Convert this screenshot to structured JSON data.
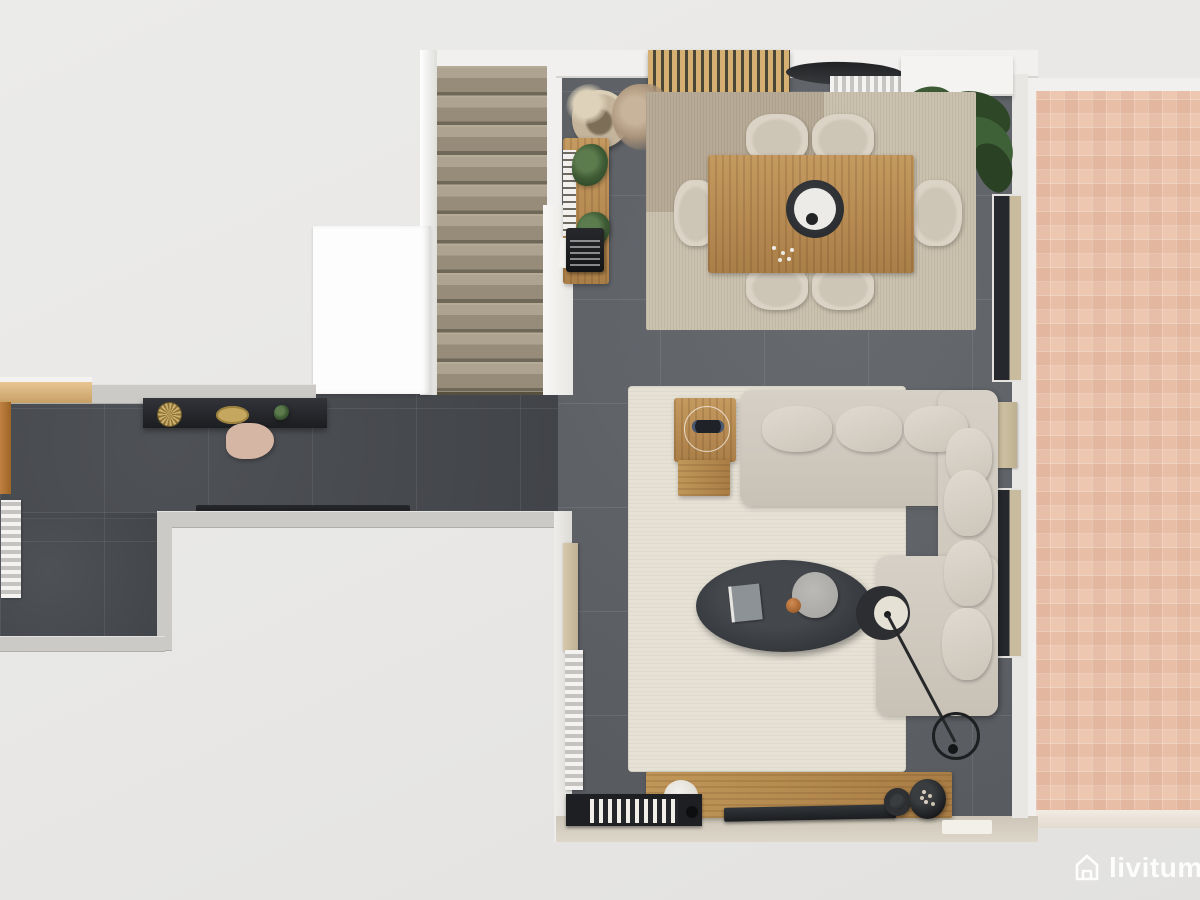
{
  "brand": {
    "name": "livitum",
    "icon": "house-icon",
    "color": "#ffffff"
  },
  "scene": {
    "type": "top-down-3d-floor-plan-render",
    "rooms": [
      {
        "name": "living-dining-room",
        "floor": "grey ceramic tile",
        "rugs": [
          "beige dining rug",
          "cream living rug"
        ]
      },
      {
        "name": "kitchen-hallway",
        "floor": "dark grey ceramic tile"
      },
      {
        "name": "staircase",
        "steps": 11,
        "material": "travertine"
      },
      {
        "name": "terrace",
        "finish": "pink brick mosaic"
      }
    ],
    "furniture": [
      "dining-table",
      "dining-chairs-x6",
      "centerpiece-bowl",
      "slatted-wood-wall-panel",
      "wall-radiators",
      "white-sideboard",
      "corner-plant",
      "pampas-basket",
      "dried-plant",
      "entry-console-with-typewriter",
      "hall-console-with-decor",
      "handbag",
      "induction-cooktop",
      "l-shaped-sectional-sofa",
      "wood-side-table",
      "oval-coffee-table",
      "arc-floor-lamp",
      "tv-media-bench",
      "flat-tv",
      "book-shelf",
      "decor-vases",
      "windows-to-terrace"
    ]
  },
  "palette": {
    "background": "#e8e7e5",
    "hall_tile": "#45484d",
    "living_tile": "#5d6166",
    "dining_rug": "#cbc1af",
    "living_rug": "#e6e1d5",
    "wood": "#b98e57",
    "sofa": "#d0cabf",
    "terrace": "#ecc6af",
    "wall": "#f1f0ee",
    "accent_dark": "#2a2c2f"
  }
}
